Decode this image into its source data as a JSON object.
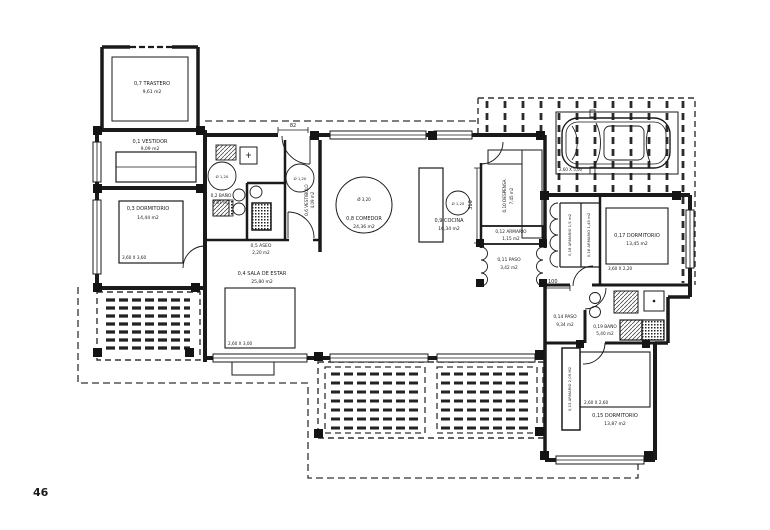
{
  "page": {
    "number": "46"
  },
  "rooms": {
    "trastero": {
      "name": "0,7 TRASTERO",
      "area": "9,61 m2"
    },
    "vestidor": {
      "name": "0,1 VESTIDOR",
      "area": "9,09 m2"
    },
    "dormitorio_03": {
      "name": "0,3 DORMITORIO",
      "area": "14,44 m2",
      "dim": "3,60 X 3,60"
    },
    "bano_02": {
      "name": "0,2 BAÑO",
      "area": "5,61 m2",
      "circle": "Ø 1,20"
    },
    "sala_de_estar": {
      "name": "0,4 SALA DE ESTAR",
      "area": "25,80 m2",
      "dim": "2,60 X 3,00"
    },
    "aseo": {
      "name": "0,5 ASEO",
      "area": "2,20 m2"
    },
    "vestibulo": {
      "name": "0,6 VESTIBULO",
      "area": "4,09 m2",
      "circle": "Ø 1,20"
    },
    "comedor": {
      "name": "0,8 COMEDOR",
      "area": "24,36 m2",
      "circle": "Ø 3,20"
    },
    "cocina": {
      "name": "0,9 COCINA",
      "area": "16,34 m2",
      "circle": "Ø 1,20"
    },
    "despensa": {
      "name": "0,10 DESPENSA",
      "area": "7,45 m2"
    },
    "paso_11": {
      "name": "0,11 PASO",
      "area": "3,42 m2"
    },
    "armario_12": {
      "name": "0,12 ARMARIO",
      "area": "1,15 m2"
    },
    "armario_13": {
      "name": "0,13 ARMARIO 2,09 M2"
    },
    "paso_14": {
      "name": "0,14 PASO",
      "area": "9,34 m2"
    },
    "dormitorio_15": {
      "name": "0,15 DORMITORIO",
      "area": "13,87 m2",
      "dim": "2,60 X 2,60"
    },
    "armario_16": {
      "name": "0,16 ARMARIO 1,45 m2"
    },
    "dormitorio_17": {
      "name": "0,17 DORMITORIO",
      "area": "13,45 m2",
      "dim": "3,60 X 2,20"
    },
    "armario_18": {
      "name": "0,18 ARMARIO 1,5 m2"
    },
    "bano_19": {
      "name": "0,19 BAÑO",
      "area": "5,40 m2"
    }
  },
  "dimensions": {
    "entrance_width": "82",
    "kitchen_depth": "310",
    "hall_width": "100",
    "carport_bay": "2,60 X 5,00"
  },
  "colors": {
    "line": "#1a1a1a",
    "page_number": "#1e2a45"
  }
}
